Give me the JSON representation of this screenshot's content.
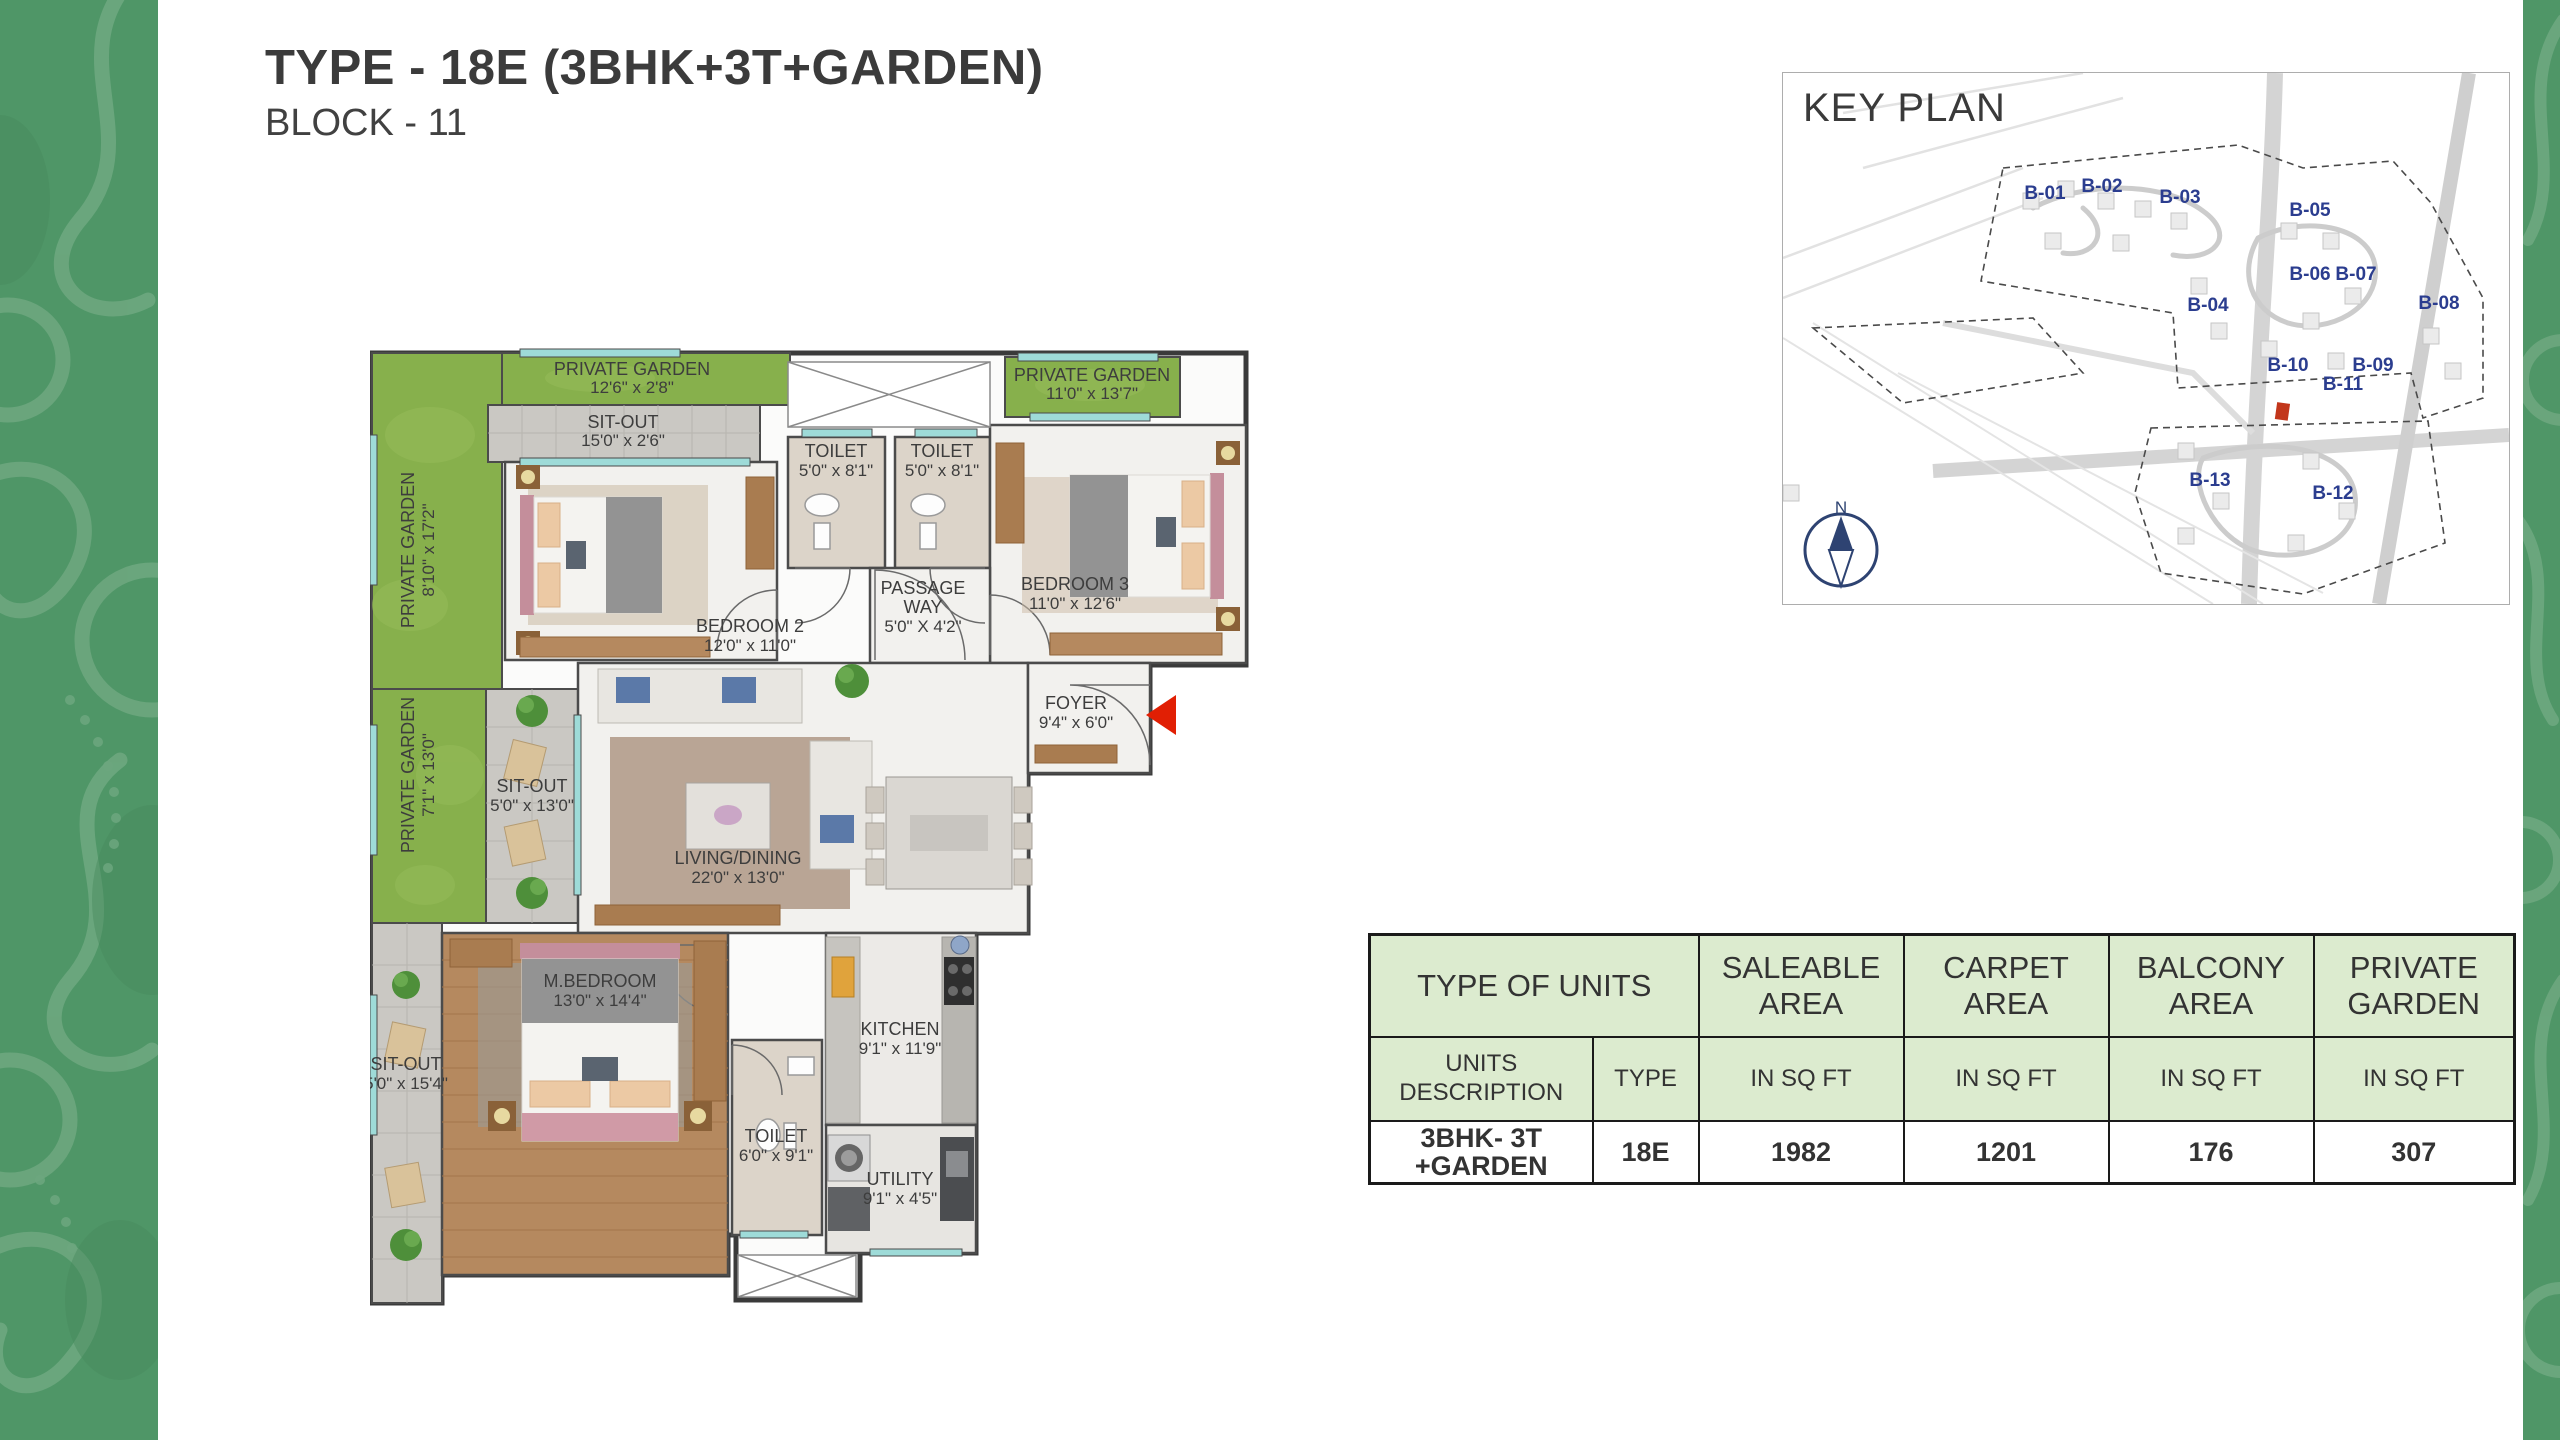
{
  "page": {
    "title": "TYPE - 18E (3BHK+3T+GARDEN)",
    "subtitle": "BLOCK - 11"
  },
  "colors": {
    "accent_red": "#d23217",
    "garden_green": "#87b04c",
    "side_band_green": "#4f9667",
    "table_header_green": "#dcebcf",
    "keyplan_label_blue": "#2b3d8f",
    "window_teal": "#9edbd8"
  },
  "floor_plan": {
    "rooms": [
      {
        "name": "PRIVATE GARDEN",
        "dims": "12'6\" x 2'8\""
      },
      {
        "name": "SIT-OUT",
        "dims": "15'0\" x 2'6\""
      },
      {
        "name": "PRIVATE GARDEN",
        "dims": "8'10\" x 17'2\""
      },
      {
        "name": "TOILET",
        "dims": "5'0\" x 8'1\""
      },
      {
        "name": "TOILET",
        "dims": "5'0\" x 8'1\""
      },
      {
        "name": "PRIVATE GARDEN",
        "dims": "11'0\" x 13'7\""
      },
      {
        "name": "BEDROOM 2",
        "dims": "12'0\" x 11'0\""
      },
      {
        "name": "BEDROOM 3",
        "dims": "11'0\" x 12'6\""
      },
      {
        "name": "PASSAGE",
        "name2": "WAY",
        "dims": "5'0\" X 4'2\""
      },
      {
        "name": "FOYER",
        "dims": "9'4\" x 6'0\""
      },
      {
        "name": "PRIVATE GARDEN",
        "dims": "7'1\" x 13'0\""
      },
      {
        "name": "SIT-OUT",
        "dims": "5'0\" x 13'0\""
      },
      {
        "name": "LIVING/DINING",
        "dims": "22'0\" x 13'0\""
      },
      {
        "name": "M.BEDROOM",
        "dims": "13'0\" x 14'4\""
      },
      {
        "name": "SIT-OUT",
        "dims": "5'0\" x 15'4\""
      },
      {
        "name": "TOILET",
        "dims": "6'0\" x 9'1\""
      },
      {
        "name": "KITCHEN",
        "dims": "9'1\" x 11'9\""
      },
      {
        "name": "UTILITY",
        "dims": "9'1\" x 4'5\""
      }
    ]
  },
  "key_plan": {
    "title": "KEY PLAN",
    "north_label": "N",
    "highlighted_block": "B-11",
    "blocks": [
      "B-01",
      "B-02",
      "B-03",
      "B-04",
      "B-05",
      "B-06",
      "B-07",
      "B-08",
      "B-09",
      "B-10",
      "B-11",
      "B-12",
      "B-13"
    ]
  },
  "units_table": {
    "header": {
      "type_of_units": "TYPE OF UNITS",
      "saleable_area": "SALEABLE AREA",
      "carpet_area": "CARPET AREA",
      "balcony_area": "BALCONY AREA",
      "private_garden": "PRIVATE GARDEN"
    },
    "subheader": {
      "units_description": "UNITS DESCRIPTION",
      "type": "TYPE",
      "unit": "IN SQ FT"
    },
    "row": {
      "units_description": "3BHK- 3T +GARDEN",
      "type": "18E",
      "saleable_area": "1982",
      "carpet_area": "1201",
      "balcony_area": "176",
      "private_garden": "307"
    }
  }
}
